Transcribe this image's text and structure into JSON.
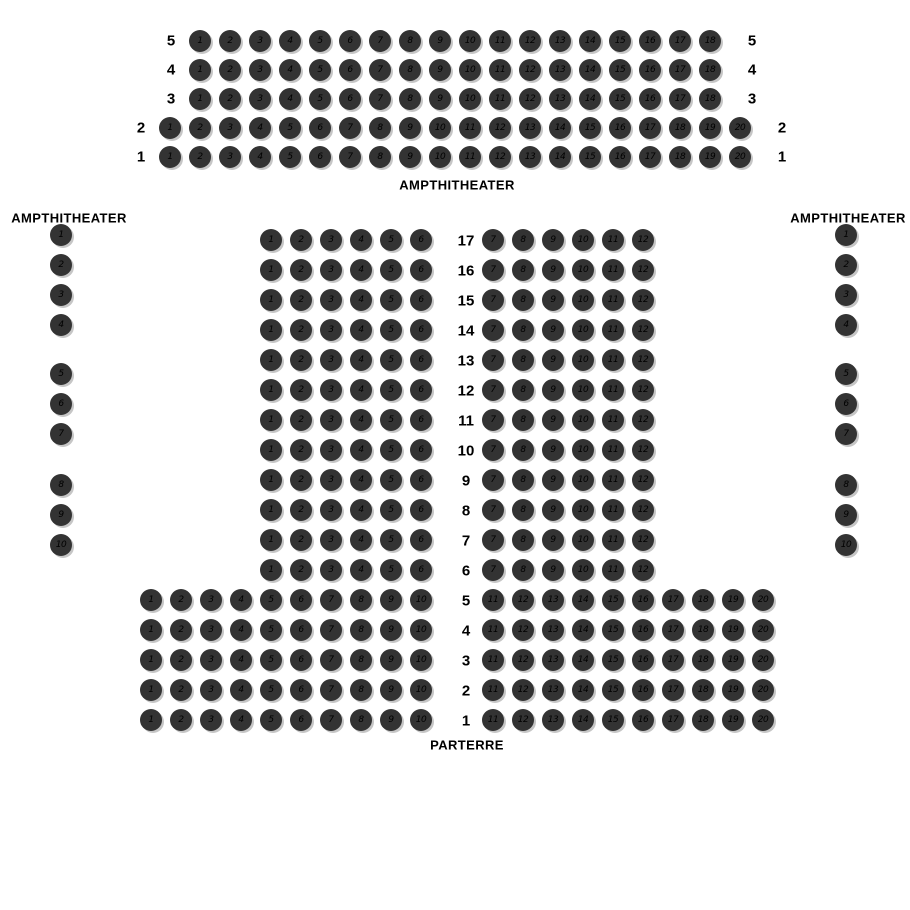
{
  "labels": {
    "top_section": "AMPTHITHEATER",
    "left_section": "AMPTHITHEATER",
    "right_section": "AMPTHITHEATER",
    "bottom_section": "PARTERRE"
  },
  "colors": {
    "background": "#ffffff",
    "seat_fill": "#333333",
    "seat_number": "#000000",
    "seat_shadow": "#c6c6c6",
    "label_text": "#000000"
  },
  "amphitheater_top": {
    "section_label": "AMPTHITHEATER",
    "row_labels_on_both_sides": true,
    "rows": [
      {
        "label": "5",
        "seats_from": 1,
        "seats_to": 18,
        "indented": true
      },
      {
        "label": "4",
        "seats_from": 1,
        "seats_to": 18,
        "indented": true
      },
      {
        "label": "3",
        "seats_from": 1,
        "seats_to": 18,
        "indented": true
      },
      {
        "label": "2",
        "seats_from": 1,
        "seats_to": 20,
        "indented": false
      },
      {
        "label": "1",
        "seats_from": 1,
        "seats_to": 20,
        "indented": false
      }
    ]
  },
  "amphitheater_left": {
    "section_label": "AMPTHITHEATER",
    "groups": [
      {
        "seats_from": 1,
        "seats_to": 4
      },
      {
        "seats_from": 5,
        "seats_to": 7
      },
      {
        "seats_from": 8,
        "seats_to": 10
      }
    ]
  },
  "amphitheater_right": {
    "section_label": "AMPTHITHEATER",
    "groups": [
      {
        "seats_from": 1,
        "seats_to": 4
      },
      {
        "seats_from": 5,
        "seats_to": 7
      },
      {
        "seats_from": 8,
        "seats_to": 10
      }
    ]
  },
  "parterre": {
    "section_label": "PARTERRE",
    "rows": [
      {
        "label": "17",
        "type": "narrow",
        "left_from": 1,
        "left_to": 6,
        "right_from": 7,
        "right_to": 12
      },
      {
        "label": "16",
        "type": "narrow",
        "left_from": 1,
        "left_to": 6,
        "right_from": 7,
        "right_to": 12
      },
      {
        "label": "15",
        "type": "narrow",
        "left_from": 1,
        "left_to": 6,
        "right_from": 7,
        "right_to": 12
      },
      {
        "label": "14",
        "type": "narrow",
        "left_from": 1,
        "left_to": 6,
        "right_from": 7,
        "right_to": 12
      },
      {
        "label": "13",
        "type": "narrow",
        "left_from": 1,
        "left_to": 6,
        "right_from": 7,
        "right_to": 12
      },
      {
        "label": "12",
        "type": "narrow",
        "left_from": 1,
        "left_to": 6,
        "right_from": 7,
        "right_to": 12
      },
      {
        "label": "11",
        "type": "narrow",
        "left_from": 1,
        "left_to": 6,
        "right_from": 7,
        "right_to": 12
      },
      {
        "label": "10",
        "type": "narrow",
        "left_from": 1,
        "left_to": 6,
        "right_from": 7,
        "right_to": 12
      },
      {
        "label": "9",
        "type": "narrow",
        "left_from": 1,
        "left_to": 6,
        "right_from": 7,
        "right_to": 12
      },
      {
        "label": "8",
        "type": "narrow",
        "left_from": 1,
        "left_to": 6,
        "right_from": 7,
        "right_to": 12
      },
      {
        "label": "7",
        "type": "narrow",
        "left_from": 1,
        "left_to": 6,
        "right_from": 7,
        "right_to": 12
      },
      {
        "label": "6",
        "type": "narrow",
        "left_from": 1,
        "left_to": 6,
        "right_from": 7,
        "right_to": 12
      },
      {
        "label": "5",
        "type": "wide",
        "left_from": 1,
        "left_to": 10,
        "right_from": 11,
        "right_to": 20
      },
      {
        "label": "4",
        "type": "wide",
        "left_from": 1,
        "left_to": 10,
        "right_from": 11,
        "right_to": 20
      },
      {
        "label": "3",
        "type": "wide",
        "left_from": 1,
        "left_to": 10,
        "right_from": 11,
        "right_to": 20
      },
      {
        "label": "2",
        "type": "wide",
        "left_from": 1,
        "left_to": 10,
        "right_from": 11,
        "right_to": 20
      },
      {
        "label": "1",
        "type": "wide",
        "left_from": 1,
        "left_to": 10,
        "right_from": 11,
        "right_to": 20
      }
    ]
  }
}
